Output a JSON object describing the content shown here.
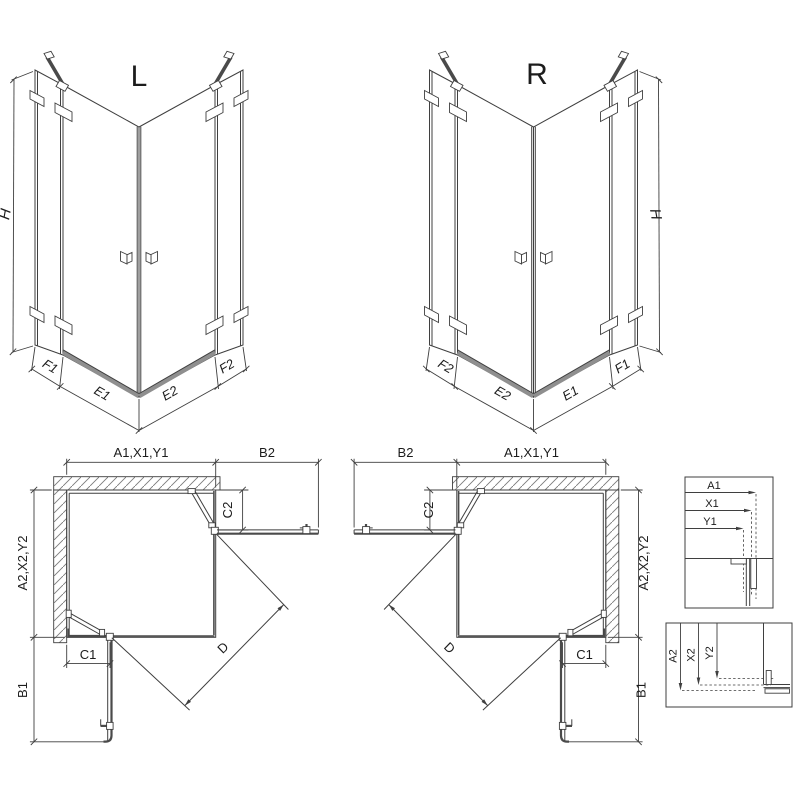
{
  "colors": {
    "line": "#3f3f3f",
    "panel": "#4a4a4a",
    "threshold": "#8f8f8f",
    "text": "#1c1c1c",
    "hatch": "#7a7a7a",
    "background": "#ffffff"
  },
  "iso": {
    "left": {
      "title": "L",
      "height_dim": "H",
      "bottom_dims": [
        "F1",
        "E1",
        "E2",
        "F2"
      ]
    },
    "right": {
      "title": "R",
      "height_dim": "H",
      "bottom_dims": [
        "F2",
        "E2",
        "E1",
        "F1"
      ]
    }
  },
  "plan": {
    "left": {
      "width_top": "A1,X1,Y1",
      "side_top": "B2",
      "fixed_top": "C2",
      "height_side": "A2,X2,Y2",
      "fixed_bottom": "C1",
      "side_bottom": "B1",
      "diagonal": "D"
    },
    "right": {
      "width_top": "A1,X1,Y1",
      "side_top": "B2",
      "fixed_top": "C2",
      "height_side": "A2,X2,Y2",
      "fixed_bottom": "C1",
      "side_bottom": "B1",
      "diagonal": "D"
    }
  },
  "details": {
    "top": {
      "rows": [
        "A1",
        "X1",
        "Y1"
      ]
    },
    "bottom": {
      "cols": [
        "A2",
        "X2",
        "Y2"
      ]
    }
  }
}
